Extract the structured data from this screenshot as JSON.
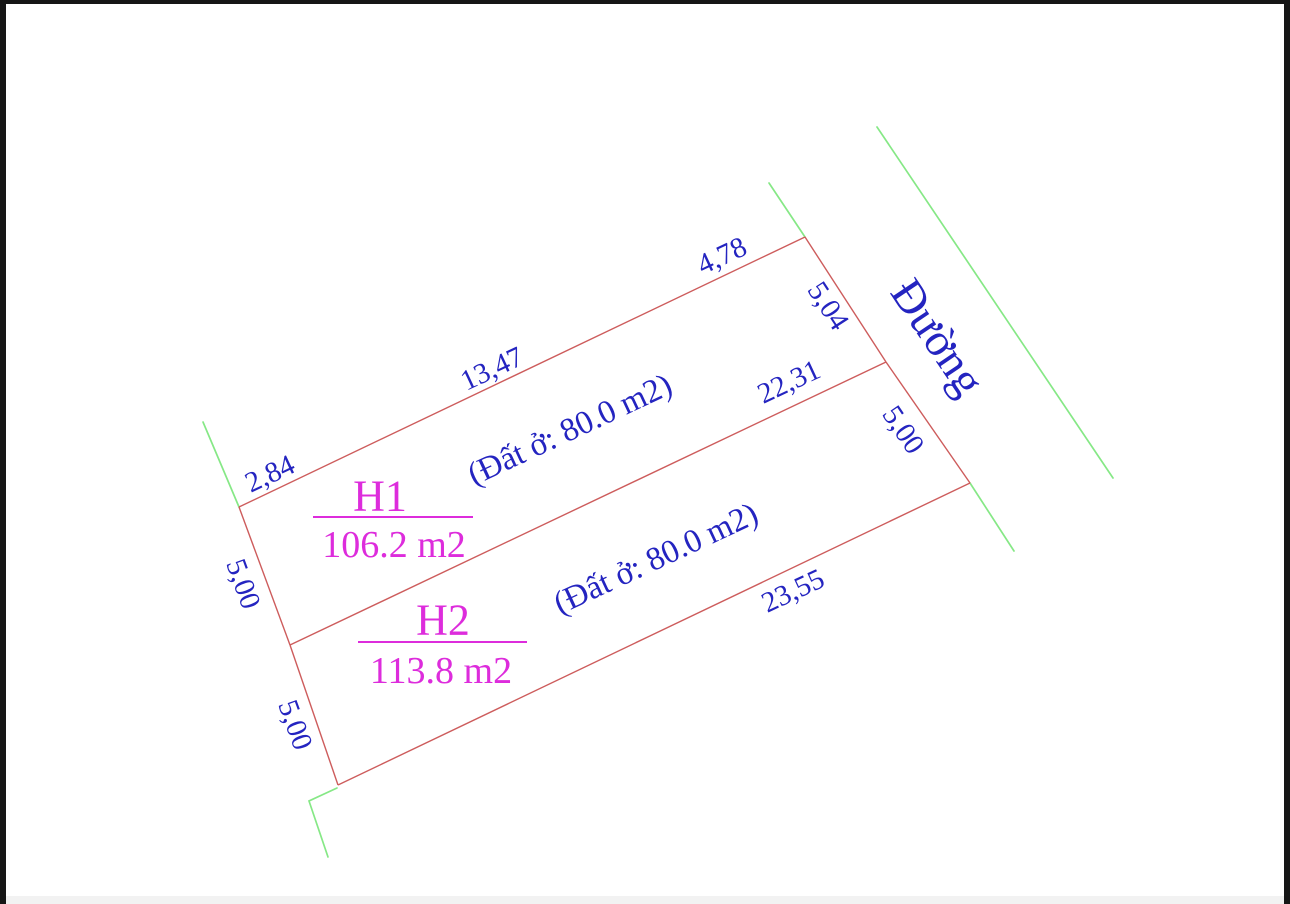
{
  "colors": {
    "parcel_line": "#cd5c5c",
    "road_line": "#86e886",
    "dimension_text": "#2424c0",
    "parcel_text": "#dd2cdc",
    "frame": "#161616",
    "footer_bar": "#f2f2f2",
    "background": "#ffffff"
  },
  "road": {
    "label": "Đường"
  },
  "parcels": {
    "h1": {
      "name": "H1",
      "area": "106.2 m2",
      "land_note": "(Đất ở: 80.0 m2)"
    },
    "h2": {
      "name": "H2",
      "area": "113.8 m2",
      "land_note": "(Đất ở: 80.0 m2)"
    }
  },
  "dimensions": {
    "top_left": "2,84",
    "top_middle": "13,47",
    "top_right": "4,78",
    "right_upper": "5,04",
    "right_lower": "5,00",
    "divider": "22,31",
    "left_upper": "5,00",
    "left_lower": "5,00",
    "bottom": "23,55"
  }
}
